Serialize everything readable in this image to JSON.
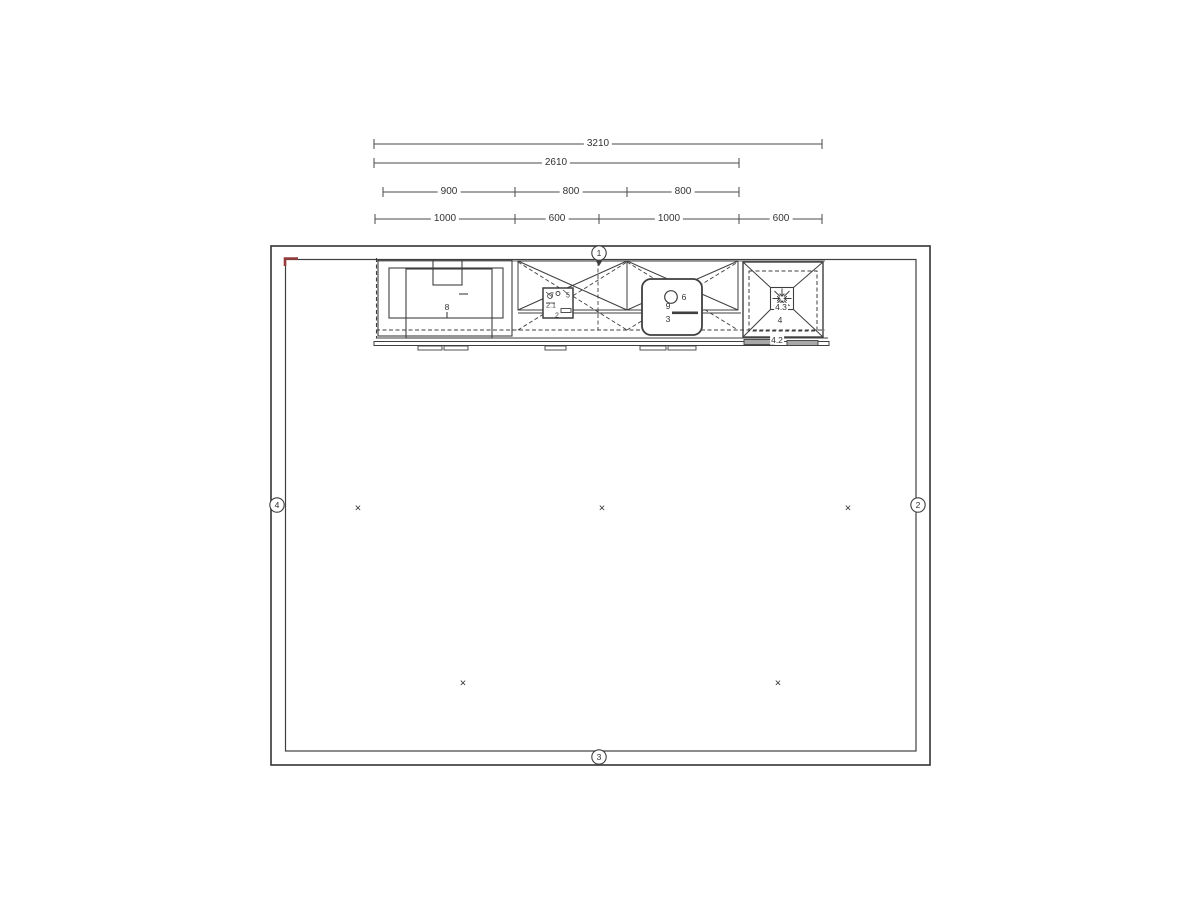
{
  "colors": {
    "line": "#3f3f3f",
    "dim_line": "#4a4a4a",
    "accent_red": "#973b3b",
    "text": "#333333"
  },
  "dimensions": {
    "rows": [
      {
        "name": "overall-width",
        "segments": [
          {
            "label": "3210"
          }
        ]
      },
      {
        "name": "cabinet-run",
        "segments": [
          {
            "label": "2610"
          }
        ]
      },
      {
        "name": "upper-row",
        "segments": [
          {
            "label": "900"
          },
          {
            "label": "800"
          },
          {
            "label": "800"
          }
        ]
      },
      {
        "name": "base-row",
        "segments": [
          {
            "label": "1000"
          },
          {
            "label": "600"
          },
          {
            "label": "1000"
          },
          {
            "label": "600"
          }
        ]
      }
    ]
  },
  "wall_markers": {
    "top": "1",
    "right": "2",
    "bottom": "3",
    "left": "4"
  },
  "units": {
    "tall_cabinet": {
      "label": "8"
    },
    "cooktop": {
      "a": "7",
      "b": "5",
      "c": "2.1",
      "d": "2"
    },
    "sink": {
      "tap": "6",
      "mid": "9",
      "front": "3"
    },
    "hood": {
      "center": "4.3",
      "main": "4",
      "front": "4.2"
    }
  },
  "ceiling_light": {
    "symbol": "×"
  }
}
